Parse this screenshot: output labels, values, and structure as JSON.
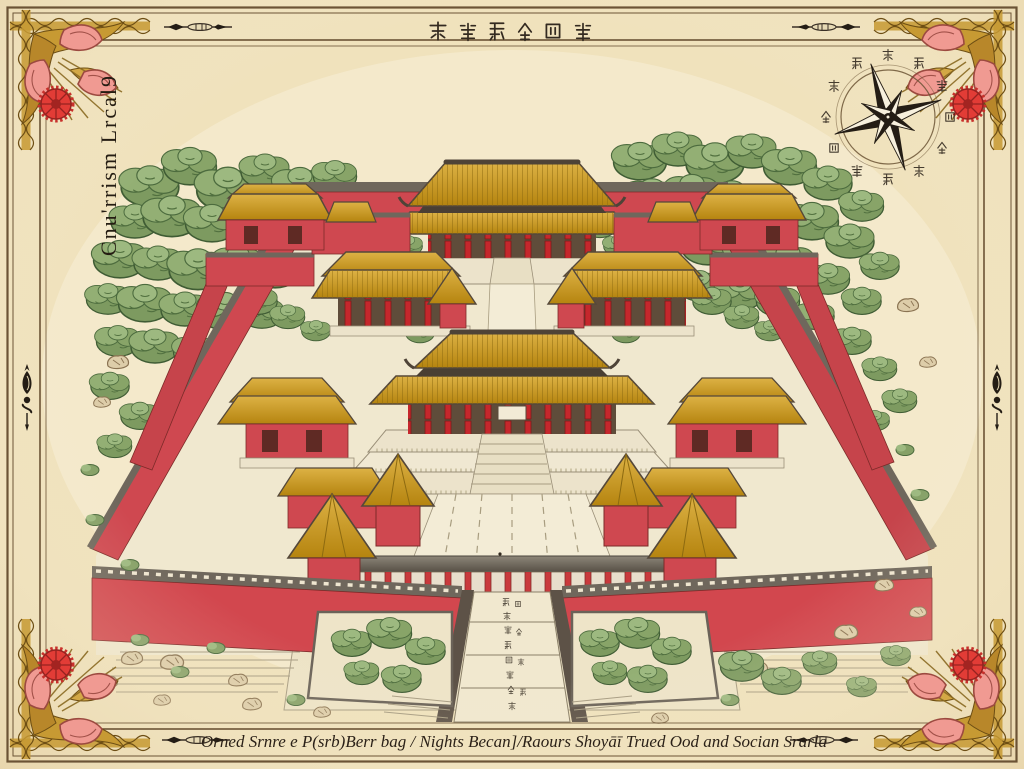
{
  "artwork": {
    "kind": "antique illustrated map",
    "subject": "imperial palace complex, bird's-eye view"
  },
  "title": {
    "text": "Cnu'rrism Lrcal9",
    "orientation": "vertical"
  },
  "header_glyphs": {
    "style": "pseudo-chinese seal glyphs",
    "count": 6
  },
  "caption": {
    "text": "Orned Srnre e P(srb)Berr bag / Nights Becan]/Raours Shoyāī Trued Ood and Socian Srarla"
  },
  "compass": {
    "icon": "compass-rose-icon",
    "points": 8,
    "ring_glyphs": 12
  },
  "palette": {
    "parchment": "#f0e2bc",
    "ink": "#3a3026",
    "wall_red": "#d2474e",
    "column_red": "#c5272c",
    "roof_gold": "#c8931d",
    "roof_gray": "#6f675c",
    "stone": "#ece3cb",
    "path": "#f3ecd6",
    "tree_green": "#7d9a60",
    "flower_red": "#e23c36",
    "petal_pink": "#f09a92",
    "ornament_gold": "#c79a33"
  }
}
